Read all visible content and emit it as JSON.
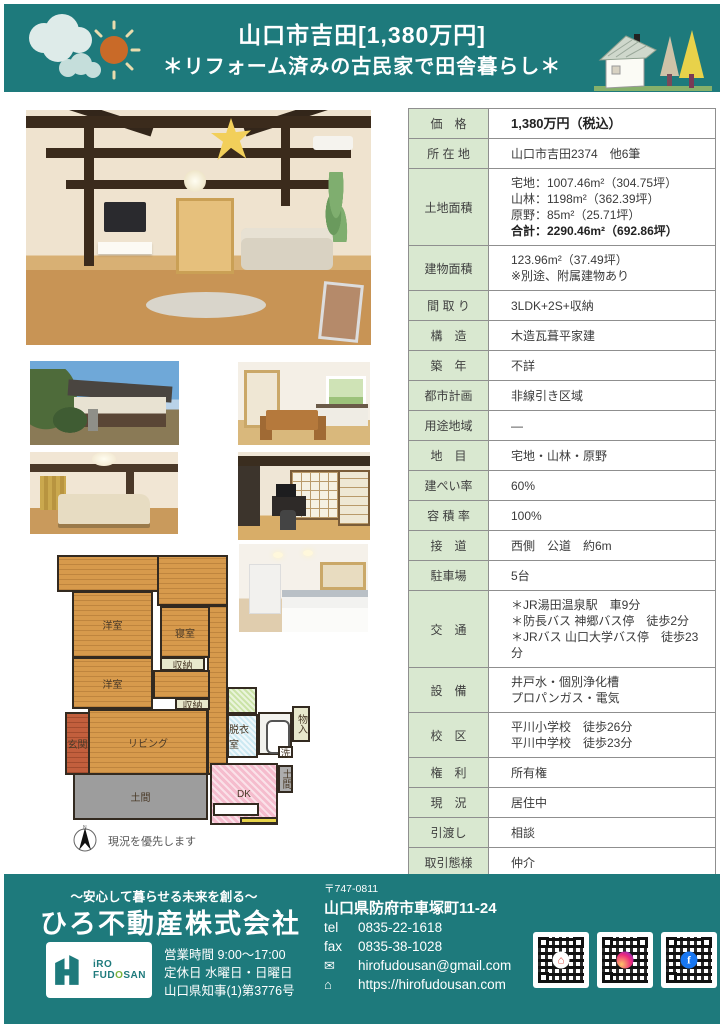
{
  "header": {
    "title": "山口市吉田[1,380万円]",
    "subtitle": "＊リフォーム済みの古民家で田舎暮らし＊"
  },
  "table": {
    "rows": [
      {
        "label": "価　格",
        "bold": "1,380万円（税込）"
      },
      {
        "label": "所 在 地",
        "value": "山口市吉田2374　他6筆"
      },
      {
        "label": "土地面積",
        "value": "宅地：1007.46m²（304.75坪）\n山林：1198m²（362.39坪）\n原野：85m²（25.71坪）",
        "bold": "合計：2290.46m²（692.86坪）"
      },
      {
        "label": "建物面積",
        "value": "123.96m²（37.49坪）\n※別途、附属建物あり"
      },
      {
        "label": "間 取 り",
        "value": "3LDK+2S+収納"
      },
      {
        "label": "構　造",
        "value": "木造瓦葺平家建"
      },
      {
        "label": "築　年",
        "value": "不詳"
      },
      {
        "label": "都市計画",
        "value": "非線引き区域"
      },
      {
        "label": "用途地域",
        "value": "―"
      },
      {
        "label": "地　目",
        "value": "宅地・山林・原野"
      },
      {
        "label": "建ぺい率",
        "value": "60%"
      },
      {
        "label": "容 積 率",
        "value": "100%"
      },
      {
        "label": "接　道",
        "value": "西側　公道　約6m"
      },
      {
        "label": "駐車場",
        "value": "5台"
      },
      {
        "label": "交　通",
        "value": "＊JR湯田温泉駅　車9分\n＊防長バス 神郷バス停　徒歩2分\n＊JRバス 山口大学バス停　徒歩23分"
      },
      {
        "label": "設　備",
        "value": "井戸水・個別浄化槽\nプロパンガス・電気"
      },
      {
        "label": "校　区",
        "value": "平川小学校　徒歩26分\n平川中学校　徒歩23分"
      },
      {
        "label": "権　利",
        "value": "所有権"
      },
      {
        "label": "現　況",
        "value": "居住中"
      },
      {
        "label": "引渡し",
        "value": "相談"
      },
      {
        "label": "取引態様",
        "value": "仲介"
      }
    ]
  },
  "floorplan": {
    "rooms": {
      "yoshitsu1": "洋室",
      "shinshitsu": "寝室",
      "shuno1": "収納",
      "yoshitsu2": "洋室",
      "shuno2": "収納",
      "genkan": "玄関",
      "living": "リビング",
      "doma": "土間",
      "dk": "DK",
      "datsuishitsu": "脱衣室",
      "monoire": "物入",
      "sen": "洗",
      "doma2": "土間"
    },
    "compass_n": "N",
    "note": "現況を優先します"
  },
  "footer": {
    "tagline": "～安心して暮らせる未来を創る～",
    "company": "ひろ不動産株式会社",
    "logo": {
      "iro": "iRO",
      "fud": "FUD",
      "o": "O",
      "san": "SAN"
    },
    "hours": "営業時間 9:00～17:00",
    "closed": "定休日 水曜日・日曜日",
    "license": "山口県知事(1)第3776号",
    "postal": "〒747-0811",
    "address": "山口県防府市車塚町11-24",
    "tel_label": "tel",
    "tel": "0835-22-1618",
    "fax_label": "fax",
    "fax": "0835-38-1028",
    "email": "hirofudousan@gmail.com",
    "url": "https://hirofudousan.com",
    "facebook_f": "f"
  },
  "colors": {
    "accent_teal": "#1e7a7c",
    "label_green": "#d9e8d0",
    "plan_wood": "#d79a4c",
    "plan_dk_pink": "#f5bccd",
    "plan_doma_gray": "#9d9d9d",
    "plan_genkan_red": "#c25f3d"
  }
}
